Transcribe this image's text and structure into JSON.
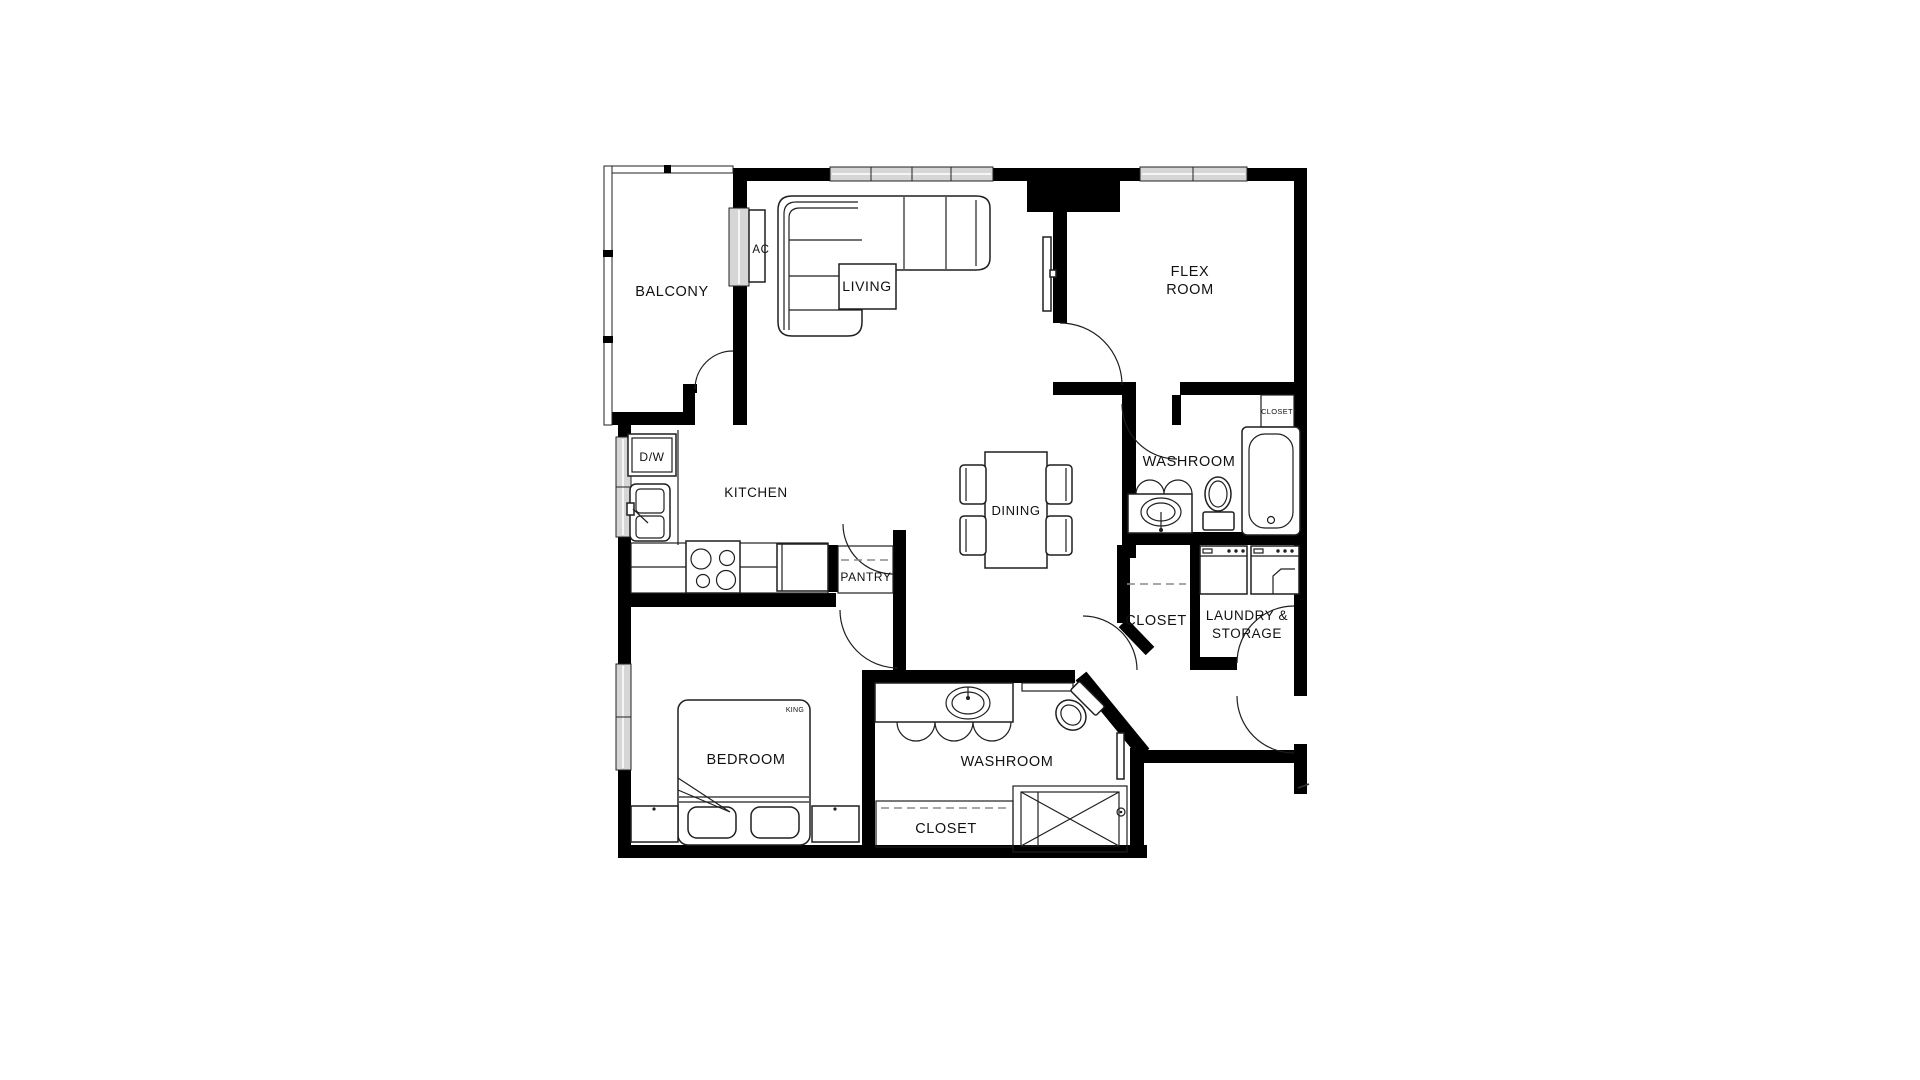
{
  "colors": {
    "wall": "#000000",
    "background": "#ffffff",
    "line": "#1f1f1f",
    "window_fill": "#d6d6d6"
  },
  "labels": {
    "balcony": "BALCONY",
    "ac": "AC",
    "living": "LIVING",
    "flex_room": {
      "line1": "FLEX",
      "line2": "ROOM"
    },
    "kitchen": "KITCHEN",
    "dishwasher": "D/W",
    "dining": "DINING",
    "washroom_upper": "WASHROOM",
    "closet_flex": "CLOSET",
    "pantry": "PANTRY",
    "closet_hall": "CLOSET",
    "laundry": {
      "line1": "LAUNDRY &",
      "line2": "STORAGE"
    },
    "bedroom": "BEDROOM",
    "bed_size": "KING",
    "washroom_lower": "WASHROOM",
    "closet_bedroom": "CLOSET"
  }
}
